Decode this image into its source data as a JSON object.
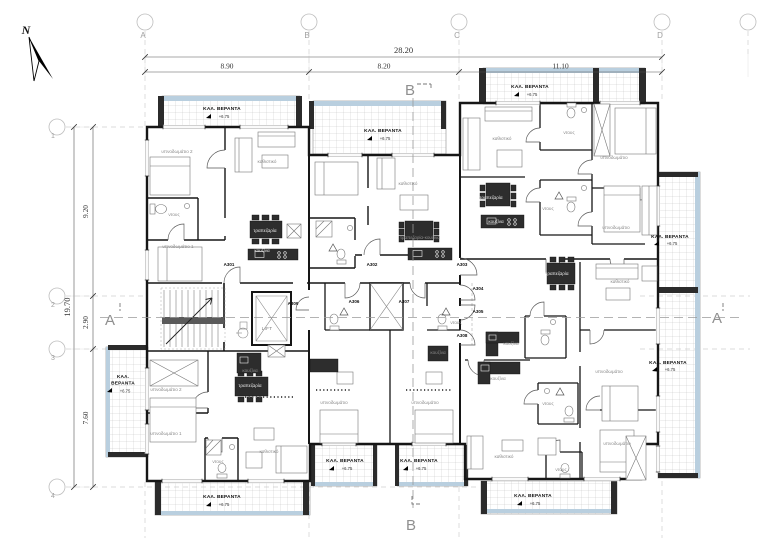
{
  "drawing": {
    "north_label": "N",
    "veranda_name": "ΚΑΛ. ΒΕΡΑΝΤΑ",
    "veranda_name_line1": "ΚΑΛ.",
    "veranda_name_line2": "ΒΕΡΑΝΤΑ",
    "veranda_level": "+6.75",
    "grid": {
      "columns": [
        {
          "label": "A",
          "x": 145
        },
        {
          "label": "B",
          "x": 309
        },
        {
          "label": "C",
          "x": 459
        },
        {
          "label": "D",
          "x": 662
        },
        {
          "label": "",
          "x": 748
        }
      ],
      "rows": [
        {
          "label": "1",
          "y": 127
        },
        {
          "label": "2",
          "y": 296
        },
        {
          "label": "3",
          "y": 349
        },
        {
          "label": "4",
          "y": 487
        }
      ]
    },
    "dimensions": {
      "top_overall": {
        "text": "28.20"
      },
      "top_segments": [
        {
          "text": "8.90"
        },
        {
          "text": "8.20"
        },
        {
          "text": "11.10"
        }
      ],
      "left_overall": {
        "text": "19.70"
      },
      "left_segments": [
        {
          "text": "9.20"
        },
        {
          "text": "2.90"
        },
        {
          "text": "7.60"
        }
      ]
    },
    "sections": [
      {
        "label": "B",
        "x": 410,
        "y": 95,
        "pos": "top"
      },
      {
        "label": "B",
        "x": 411,
        "y": 530,
        "pos": "bottom"
      },
      {
        "label": "A",
        "x": 110,
        "y": 325,
        "pos": "left"
      },
      {
        "label": "A",
        "x": 717,
        "y": 323,
        "pos": "right"
      }
    ],
    "apartments": [
      {
        "id": "A301",
        "x": 229,
        "y": 266
      },
      {
        "id": "A302",
        "x": 372,
        "y": 266
      },
      {
        "id": "A303",
        "x": 462,
        "y": 266
      },
      {
        "id": "A304",
        "x": 478,
        "y": 290
      },
      {
        "id": "A305",
        "x": 478,
        "y": 313
      },
      {
        "id": "A306",
        "x": 354,
        "y": 303
      },
      {
        "id": "A307",
        "x": 404,
        "y": 303
      },
      {
        "id": "A308",
        "x": 462,
        "y": 337
      },
      {
        "id": "A309",
        "x": 293,
        "y": 305
      }
    ],
    "verandas": [
      {
        "x": 222,
        "y": 110,
        "level_y": 118
      },
      {
        "x": 383,
        "y": 132,
        "level_y": 140
      },
      {
        "x": 530,
        "y": 88,
        "level_y": 96
      },
      {
        "x": 670,
        "y": 238,
        "level_y": 245
      },
      {
        "x": 668,
        "y": 364,
        "level_y": 371
      },
      {
        "x": 123,
        "y": 378,
        "stacked": true
      },
      {
        "x": 222,
        "y": 498,
        "level_y": 506
      },
      {
        "x": 345,
        "y": 462,
        "level_y": 470
      },
      {
        "x": 419,
        "y": 462,
        "level_y": 470
      },
      {
        "x": 533,
        "y": 497,
        "level_y": 505
      }
    ],
    "rooms": [
      {
        "text": "υπνοδωμάτιο 2",
        "x": 177,
        "y": 153
      },
      {
        "text": "καθιστικό",
        "x": 267,
        "y": 163
      },
      {
        "text": "ντους",
        "x": 174,
        "y": 216
      },
      {
        "text": "υπνοδωμάτιο 1",
        "x": 178,
        "y": 248
      },
      {
        "text": "τραπεζαρία",
        "x": 265,
        "y": 232,
        "light": true
      },
      {
        "text": "κουζίνα",
        "x": 262,
        "y": 252,
        "light": true
      },
      {
        "text": "καθιστικό",
        "x": 408,
        "y": 185
      },
      {
        "text": "τραπεζαρία-κουζίνα",
        "x": 420,
        "y": 239
      },
      {
        "text": "καθιστικό",
        "x": 502,
        "y": 140
      },
      {
        "text": "ντους",
        "x": 569,
        "y": 134
      },
      {
        "text": "υπνοδωμάτιο",
        "x": 614,
        "y": 159
      },
      {
        "text": "τραπεζαρία",
        "x": 491,
        "y": 199,
        "light": true
      },
      {
        "text": "κουζίνα",
        "x": 496,
        "y": 223,
        "light": true
      },
      {
        "text": "ντους",
        "x": 548,
        "y": 210
      },
      {
        "text": "υπνοδωμάτιο",
        "x": 616,
        "y": 229
      },
      {
        "text": "τραπεζαρία",
        "x": 557,
        "y": 275,
        "light": true
      },
      {
        "text": "καθιστικό",
        "x": 620,
        "y": 283
      },
      {
        "text": "κουζίνα",
        "x": 511,
        "y": 345
      },
      {
        "text": "ντους",
        "x": 456,
        "y": 324
      },
      {
        "text": "κουζίνα",
        "x": 438,
        "y": 354
      },
      {
        "text": "υπνοδωμάτιο",
        "x": 334,
        "y": 404
      },
      {
        "text": "υπνοδωμάτιο",
        "x": 425,
        "y": 404
      },
      {
        "text": "υπνοδωμάτιο 2",
        "x": 166,
        "y": 391
      },
      {
        "text": "κουζίνα",
        "x": 250,
        "y": 372
      },
      {
        "text": "τραπεζαρία",
        "x": 250,
        "y": 387,
        "light": true
      },
      {
        "text": "υπνοδωμάτιο 1",
        "x": 166,
        "y": 435
      },
      {
        "text": "ντους",
        "x": 218,
        "y": 463
      },
      {
        "text": "καθιστικό",
        "x": 269,
        "y": 453
      },
      {
        "text": "κουζίνα",
        "x": 498,
        "y": 380
      },
      {
        "text": "ντους",
        "x": 548,
        "y": 405
      },
      {
        "text": "υπνοδωμάτιο",
        "x": 609,
        "y": 373
      },
      {
        "text": "υπνοδωμάτιο",
        "x": 617,
        "y": 445
      },
      {
        "text": "ντους",
        "x": 561,
        "y": 471
      },
      {
        "text": "καθιστικό",
        "x": 504,
        "y": 458
      },
      {
        "text": "LIFT",
        "x": 267,
        "y": 330,
        "lift": true
      }
    ]
  }
}
